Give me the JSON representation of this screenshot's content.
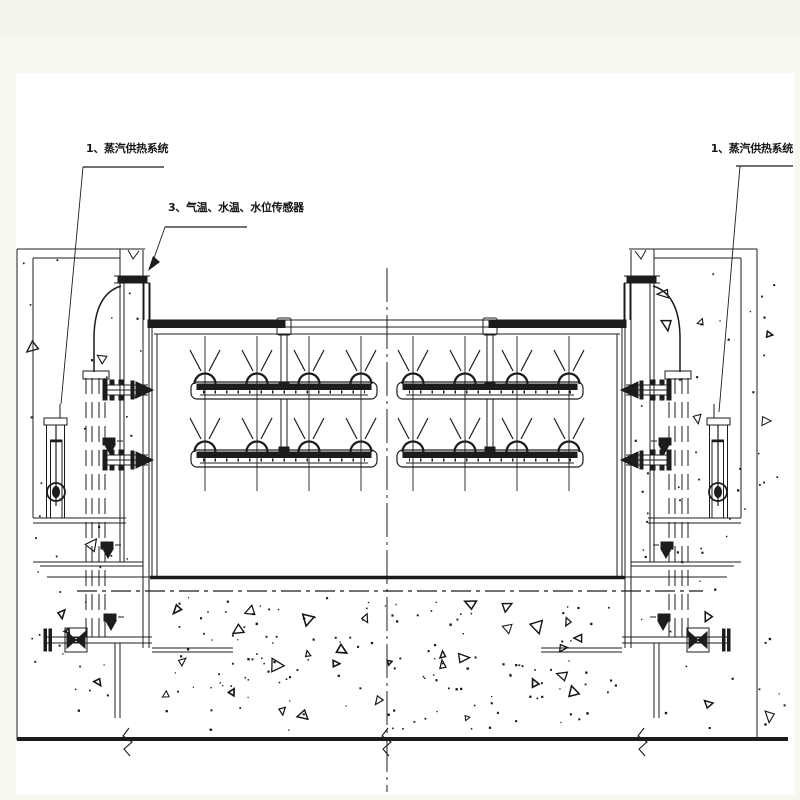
{
  "drawing": {
    "type": "engineering-section-drawing",
    "labels": {
      "steam_system_left": "1、蒸汽供热系统",
      "sensors": "3、气温、水温、水位传感器",
      "steam_system_right": "1、蒸汽供热系统"
    },
    "colors": {
      "margin": "#f7f8f0",
      "margin_top_band": "#f3f5ea",
      "paper": "#ffffff",
      "ink": "#1c1c1c"
    }
  }
}
